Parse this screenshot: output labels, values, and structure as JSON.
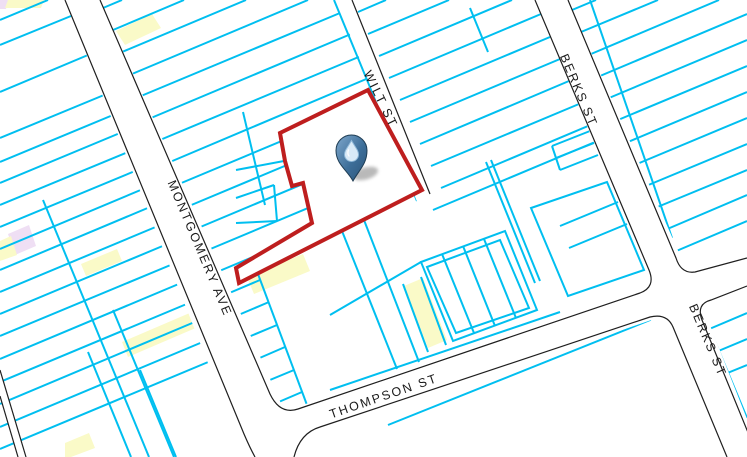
{
  "map": {
    "colors": {
      "background": "#ffffff",
      "parcel_line": "#00bff0",
      "street_fill": "#ffffff",
      "street_casing": "#1f1f1f",
      "selected_outline": "#be1e1e",
      "highlight_yellow": "#fafac8",
      "highlight_pink": "#efdff4",
      "label_text": "#1a1a1a",
      "marker_blue": "#3d6e99"
    },
    "street_labels": [
      {
        "text": "MONTGOMERY AVE",
        "x": 196,
        "y": 250,
        "rotate": 67
      },
      {
        "text": "WILT ST",
        "x": 377,
        "y": 101,
        "rotate": 64
      },
      {
        "text": "BERKS ST",
        "x": 575,
        "y": 92,
        "rotate": 67
      },
      {
        "text": "BERKS ST",
        "x": 704,
        "y": 342,
        "rotate": 67
      },
      {
        "text": "THOMPSON ST",
        "x": 385,
        "y": 400,
        "rotate": -19
      }
    ],
    "street_fills": [
      [
        [
          65,
          0
        ],
        [
          100,
          0
        ],
        [
          305,
          457
        ],
        [
          245,
          457
        ]
      ],
      [
        [
          336,
          0
        ],
        [
          352,
          0
        ],
        [
          431,
          193
        ],
        [
          418,
          204
        ]
      ],
      [
        [
          535,
          0
        ],
        [
          568,
          0
        ],
        [
          690,
          278
        ],
        [
          655,
          290
        ]
      ],
      [
        [
          282,
          412
        ],
        [
          747,
          255
        ],
        [
          747,
          287
        ],
        [
          292,
          444
        ]
      ],
      [
        [
          650,
          318
        ],
        [
          700,
          300
        ],
        [
          762,
          457
        ],
        [
          713,
          457
        ]
      ],
      [
        [
          0,
          370
        ],
        [
          26,
          457
        ],
        [
          18,
          457
        ],
        [
          0,
          396
        ]
      ]
    ],
    "street_casings": [
      "M 65 0 L 244 434 Q 250 448 255 457",
      "M 100 0 L 270 394 Q 280 415 298 409 L 640 293 Q 656 287 649 270 L 535 0",
      "M 568 0 L 676 258 Q 681 274 695 272 L 747 258",
      "M 747 286 L 711 300 Q 696 304 702 320 L 758 457",
      "M 727 457 L 673 327 Q 667 313 650 317 L 320 427 Q 300 433 294 457",
      "M 352 0 L 430 194",
      "M 0 370 L 26 457",
      "M 0 396 L 18 457"
    ],
    "parcel_lines": [
      [
        0,
        20,
        48,
        0
      ],
      [
        0,
        45,
        71,
        16
      ],
      [
        0,
        92,
        88,
        55
      ],
      [
        0,
        138,
        104,
        95
      ],
      [
        0,
        162,
        113,
        115
      ],
      [
        0,
        183,
        120,
        133
      ],
      [
        0,
        205,
        128,
        152
      ],
      [
        0,
        227,
        135,
        171
      ],
      [
        0,
        249,
        143,
        189
      ],
      [
        0,
        270,
        150,
        207
      ],
      [
        0,
        292,
        158,
        226
      ],
      [
        0,
        314,
        165,
        245
      ],
      [
        0,
        336,
        173,
        264
      ],
      [
        0,
        359,
        181,
        283
      ],
      [
        0,
        382,
        189,
        303
      ],
      [
        0,
        404,
        197,
        321
      ],
      [
        0,
        427,
        205,
        341
      ],
      [
        0,
        449,
        213,
        360
      ],
      [
        43,
        200,
        149,
        457
      ],
      [
        113,
        310,
        174,
        457
      ],
      [
        88,
        352,
        131,
        457
      ],
      [
        140,
        370,
        176,
        457
      ],
      [
        103,
        8,
        122,
        0
      ],
      [
        113,
        30,
        184,
        0
      ],
      [
        122,
        52,
        246,
        0
      ],
      [
        132,
        74,
        308,
        0
      ],
      [
        141,
        96,
        340,
        13
      ],
      [
        151,
        118,
        351,
        34
      ],
      [
        160,
        140,
        361,
        56
      ],
      [
        170,
        162,
        371,
        77
      ],
      [
        179,
        184,
        382,
        99
      ],
      [
        189,
        206,
        392,
        121
      ],
      [
        198,
        228,
        403,
        142
      ],
      [
        208,
        250,
        413,
        164
      ],
      [
        217,
        272,
        424,
        185
      ],
      [
        227,
        294,
        260,
        280
      ],
      [
        236,
        316,
        269,
        302
      ],
      [
        246,
        338,
        277,
        325
      ],
      [
        255,
        360,
        285,
        347
      ],
      [
        265,
        382,
        294,
        370
      ],
      [
        274,
        404,
        302,
        392
      ],
      [
        243,
        112,
        265,
        205
      ],
      [
        258,
        274,
        307,
        405
      ],
      [
        236,
        170,
        284,
        161
      ],
      [
        236,
        198,
        274,
        185
      ],
      [
        274,
        185,
        277,
        221
      ],
      [
        236,
        223,
        277,
        221
      ],
      [
        334,
        0,
        417,
        201
      ],
      [
        358,
        12,
        386,
        0
      ],
      [
        368,
        34,
        449,
        0
      ],
      [
        379,
        56,
        512,
        0
      ],
      [
        389,
        78,
        541,
        14
      ],
      [
        400,
        100,
        550,
        37
      ],
      [
        410,
        122,
        560,
        59
      ],
      [
        420,
        144,
        569,
        81
      ],
      [
        431,
        166,
        579,
        104
      ],
      [
        441,
        188,
        588,
        126
      ],
      [
        433,
        210,
        595,
        142
      ],
      [
        470,
        8,
        488,
        52
      ],
      [
        552,
        146,
        590,
        131
      ],
      [
        556,
        158,
        594,
        143
      ],
      [
        560,
        170,
        598,
        155
      ],
      [
        552,
        146,
        560,
        170
      ],
      [
        572,
        10,
        596,
        0
      ],
      [
        581,
        32,
        658,
        0
      ],
      [
        591,
        54,
        719,
        0
      ],
      [
        600,
        76,
        747,
        14
      ],
      [
        609,
        98,
        747,
        40
      ],
      [
        618,
        120,
        747,
        66
      ],
      [
        628,
        142,
        747,
        92
      ],
      [
        637,
        164,
        747,
        118
      ],
      [
        646,
        186,
        747,
        144
      ],
      [
        655,
        208,
        747,
        170
      ],
      [
        665,
        230,
        747,
        195
      ],
      [
        674,
        252,
        747,
        221
      ],
      [
        590,
        0,
        672,
        238
      ],
      [
        342,
        231,
        397,
        369
      ],
      [
        364,
        220,
        419,
        362
      ],
      [
        403,
        284,
        428,
        352
      ],
      [
        421,
        277,
        446,
        345
      ],
      [
        330,
        315,
        421,
        262
      ],
      [
        486,
        162,
        535,
        283
      ],
      [
        491,
        160,
        540,
        281
      ],
      [
        442,
        254,
        474,
        333
      ],
      [
        463,
        246,
        495,
        326
      ],
      [
        484,
        239,
        516,
        318
      ],
      [
        618,
        202,
        560,
        226
      ],
      [
        627,
        224,
        569,
        248
      ],
      [
        330,
        390,
        560,
        312
      ],
      [
        388,
        425,
        700,
        300
      ],
      [
        702,
        310,
        747,
        418
      ],
      [
        707,
        330,
        747,
        313
      ],
      [
        716,
        352,
        747,
        339
      ],
      [
        725,
        374,
        747,
        365
      ]
    ],
    "parcel_polys": [
      [
        [
          531,
          208
        ],
        [
          607,
          182
        ],
        [
          644,
          270
        ],
        [
          568,
          296
        ]
      ],
      [
        [
          421,
          262
        ],
        [
          505,
          231
        ],
        [
          537,
          310
        ],
        [
          453,
          341
        ]
      ],
      [
        [
          427,
          267
        ],
        [
          500,
          240
        ],
        [
          529,
          308
        ],
        [
          456,
          333
        ]
      ]
    ],
    "highlights": [
      {
        "color": "pink",
        "points": [
          [
            0,
            0
          ],
          [
            8,
            0
          ],
          [
            6,
            9
          ],
          [
            0,
            9
          ]
        ]
      },
      {
        "color": "yellow",
        "points": [
          [
            8,
            0
          ],
          [
            44,
            0
          ],
          [
            41,
            8
          ],
          [
            5,
            8
          ]
        ]
      },
      {
        "color": "yellow",
        "points": [
          [
            116,
            31
          ],
          [
            152,
            14
          ],
          [
            161,
            28
          ],
          [
            125,
            45
          ]
        ]
      },
      {
        "color": "pink",
        "points": [
          [
            8,
            234
          ],
          [
            29,
            225
          ],
          [
            36,
            246
          ],
          [
            15,
            255
          ]
        ]
      },
      {
        "color": "yellow",
        "points": [
          [
            0,
            241
          ],
          [
            11,
            236
          ],
          [
            17,
            255
          ],
          [
            0,
            261
          ]
        ]
      },
      {
        "color": "yellow",
        "points": [
          [
            81,
            264
          ],
          [
            117,
            249
          ],
          [
            122,
            261
          ],
          [
            86,
            276
          ]
        ]
      },
      {
        "color": "yellow",
        "points": [
          [
            122,
            342
          ],
          [
            192,
            312
          ],
          [
            198,
            327
          ],
          [
            128,
            357
          ]
        ]
      },
      {
        "color": "yellow",
        "points": [
          [
            65,
            443
          ],
          [
            89,
            433
          ],
          [
            95,
            448
          ],
          [
            71,
            457
          ],
          [
            65,
            457
          ]
        ]
      },
      {
        "color": "yellow",
        "points": [
          [
            247,
            277
          ],
          [
            303,
            254
          ],
          [
            310,
            271
          ],
          [
            254,
            294
          ]
        ]
      },
      {
        "color": "yellow",
        "points": [
          [
            404,
            286
          ],
          [
            423,
            278
          ],
          [
            447,
            340
          ],
          [
            428,
            348
          ]
        ]
      }
    ],
    "selected_parcel": {
      "points": [
        [
          368,
          90
        ],
        [
          422,
          190
        ],
        [
          239,
          283
        ],
        [
          236,
          268
        ],
        [
          312,
          223
        ],
        [
          303,
          183
        ],
        [
          292,
          186
        ],
        [
          285,
          161
        ],
        [
          280,
          133
        ]
      ],
      "stroke_width": 4
    },
    "marker": {
      "name": "water-drop-marker",
      "x": 351.5,
      "y": 150.5,
      "tip_y": 181
    }
  }
}
